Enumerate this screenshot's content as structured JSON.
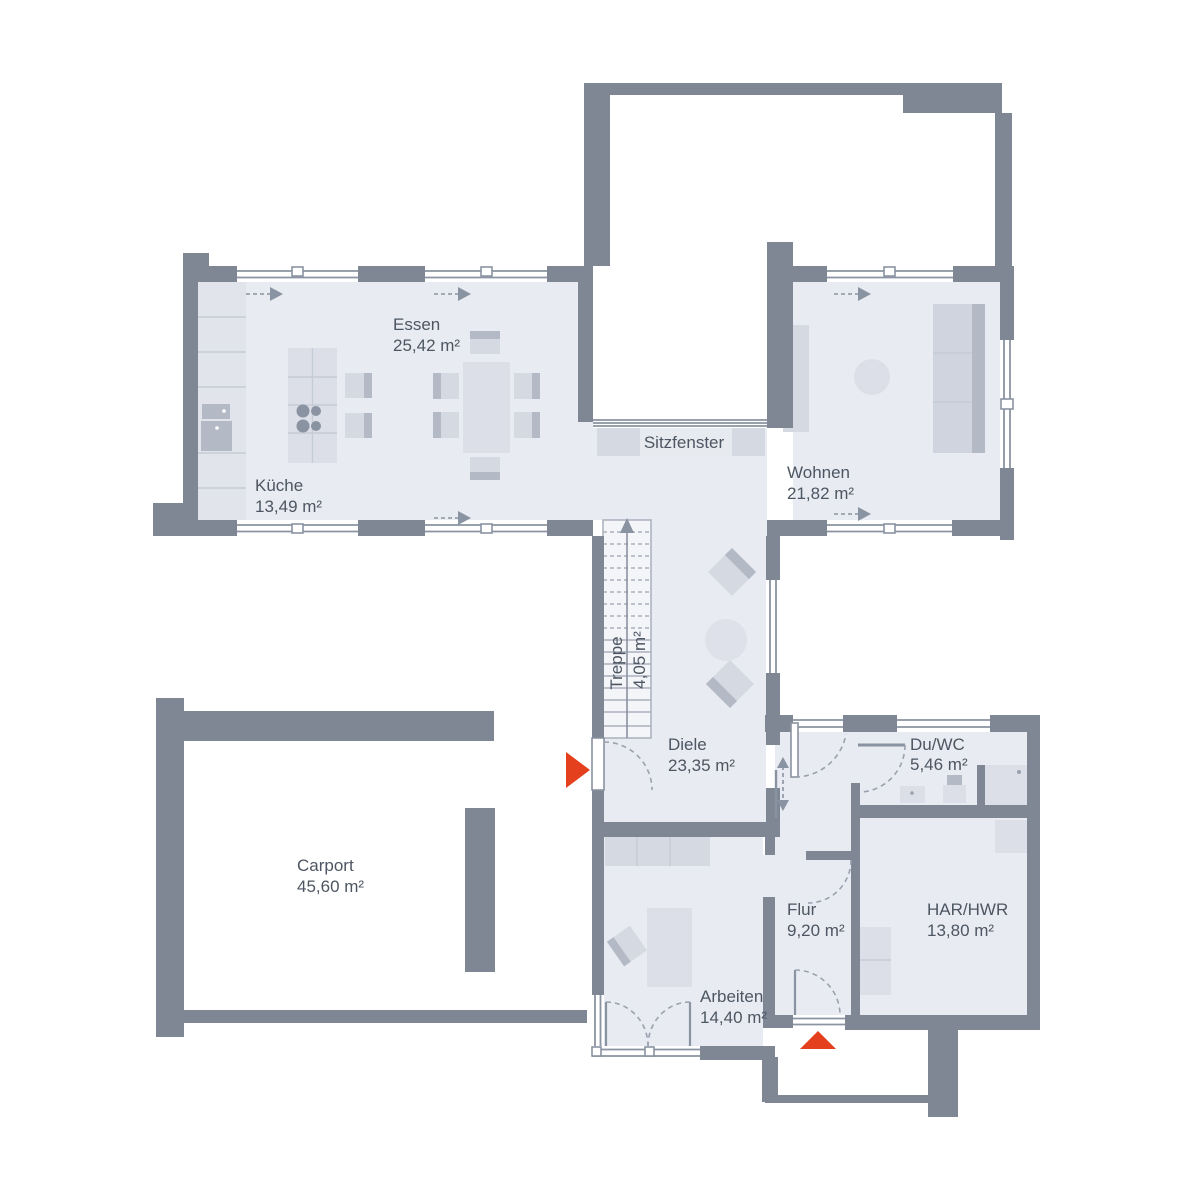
{
  "rooms": {
    "essen": {
      "label": "Essen",
      "area": "25,42 m²"
    },
    "kueche": {
      "label": "Küche",
      "area": "13,49 m²"
    },
    "wohnen": {
      "label": "Wohnen",
      "area": "21,82 m²"
    },
    "treppe": {
      "label": "Treppe",
      "area": "4,05 m²"
    },
    "diele": {
      "label": "Diele",
      "area": "23,35 m²"
    },
    "du_wc": {
      "label": "Du/WC",
      "area": "5,46 m²"
    },
    "carport": {
      "label": "Carport",
      "area": "45,60 m²"
    },
    "flur": {
      "label": "Flur",
      "area": "9,20 m²"
    },
    "har_hwr": {
      "label": "HAR/HWR",
      "area": "13,80 m²"
    },
    "arbeiten": {
      "label": "Arbeiten",
      "area": "14,40 m²"
    },
    "sitzfenster": {
      "label": "Sitzfenster"
    }
  },
  "colors": {
    "wall": "#7f8795",
    "floor": "#e8ebf1",
    "furniture": "#d5dae2",
    "furniture_dark": "#b3bac6",
    "entrance_arrow": "#e5401d",
    "text": "#4d5662"
  }
}
